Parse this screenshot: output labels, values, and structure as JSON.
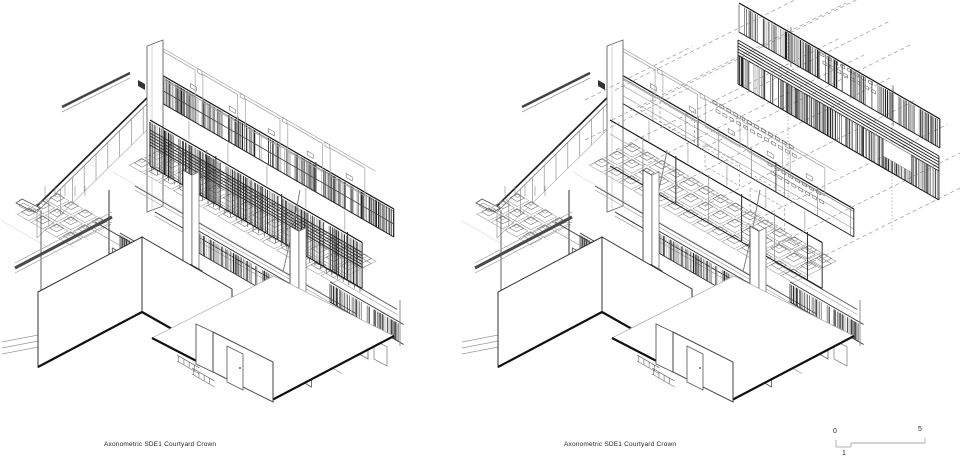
{
  "page": {
    "background": "#ffffff"
  },
  "figures": [
    {
      "id": "left",
      "caption": "Axonometric SDE1 Courtyard Crown",
      "state": "assembled"
    },
    {
      "id": "right",
      "caption": "Axonometric SDE1 Courtyard Crown",
      "state": "exploded-crown-screens"
    }
  ],
  "scale_bar": {
    "labels": {
      "zero": "0",
      "one": "1",
      "five": "5"
    }
  },
  "ink": {
    "dark": "#1a1a1a",
    "mid": "#555555",
    "soft": "#777777",
    "light": "#999999",
    "faint": "#bbbbbb",
    "pale": "#cccccc"
  }
}
